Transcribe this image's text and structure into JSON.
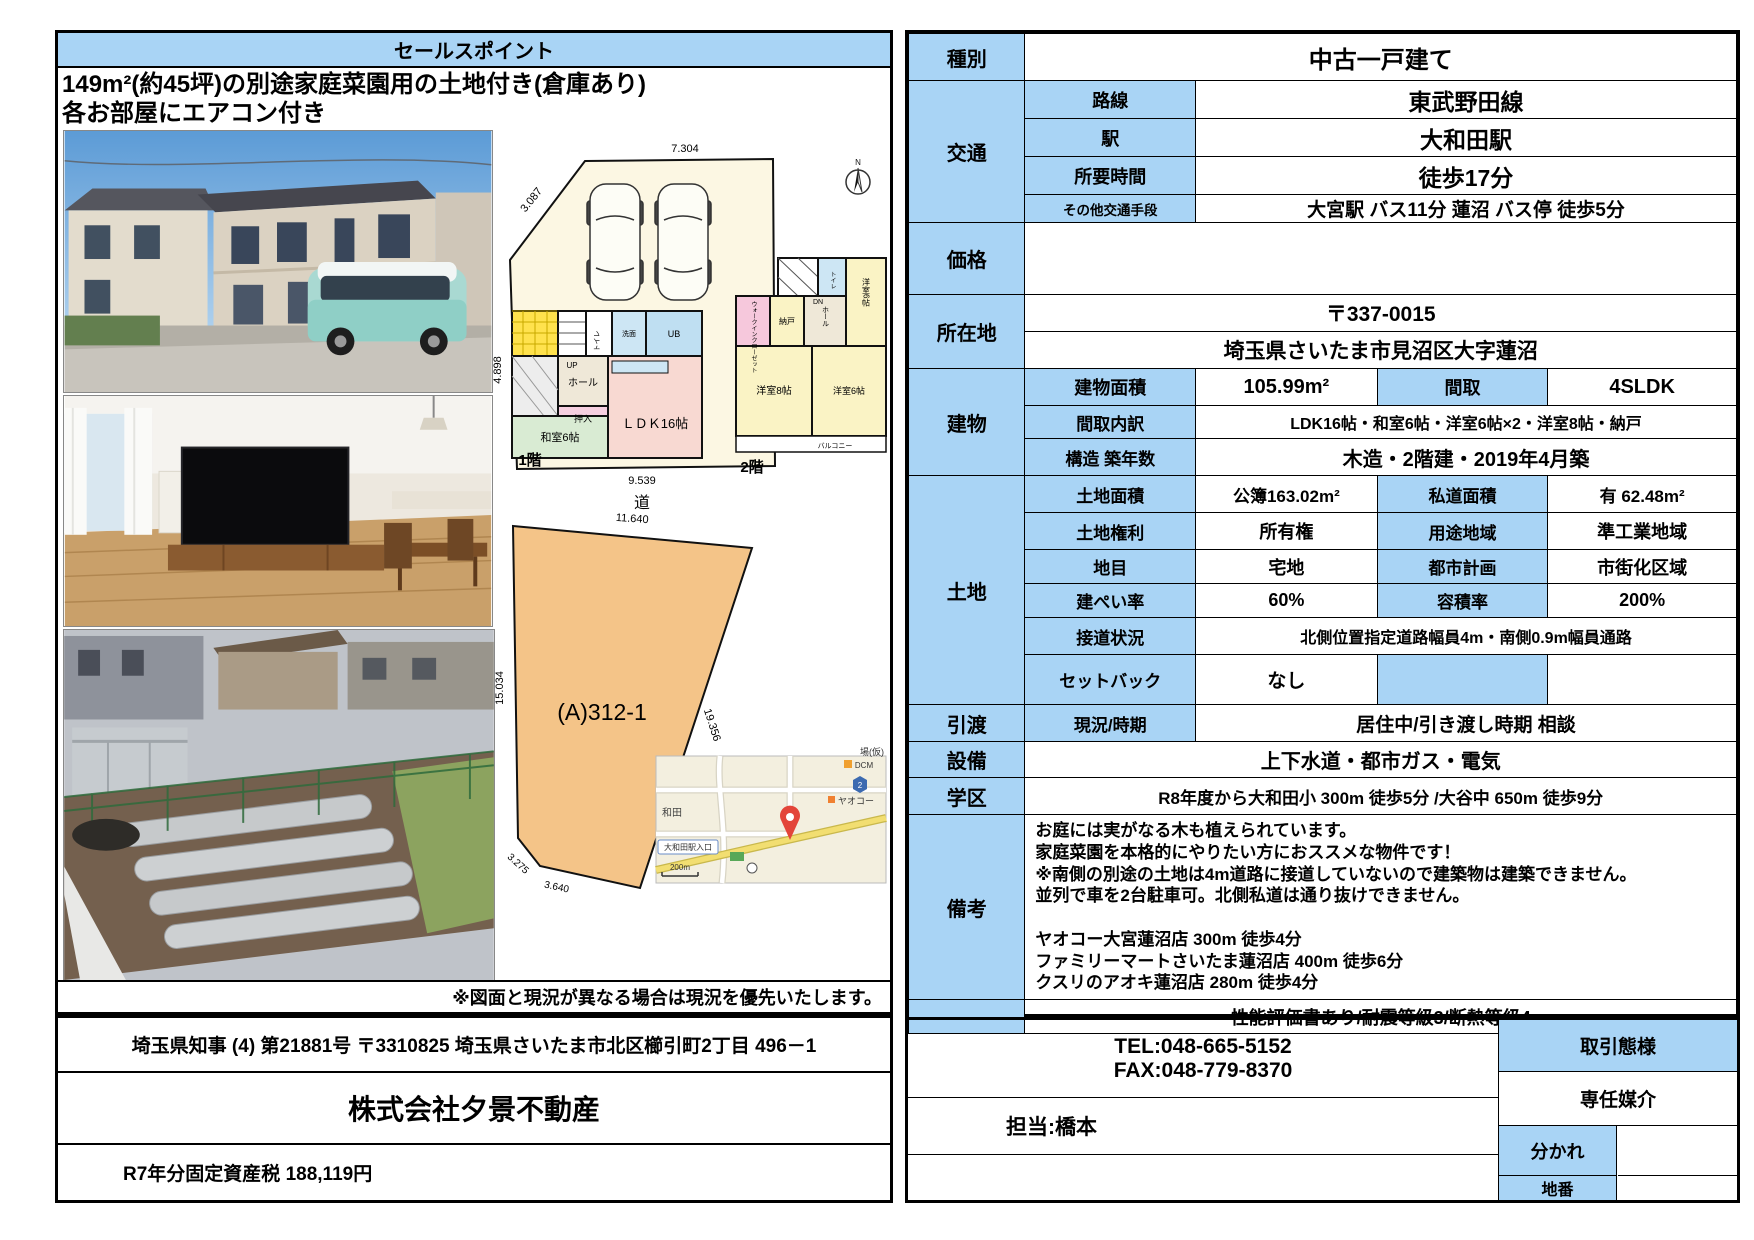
{
  "colors": {
    "cell_blue": "#A9D4F5",
    "plot_orange": "#F4C488",
    "map_bg": "#F3EFDF",
    "pin_red": "#E3453A"
  },
  "left": {
    "header": "セールスポイント",
    "sales_line1": "149m²(約45坪)の別途家庭菜園用の土地付き(倉庫あり)",
    "sales_line2": "各お部屋にエアコン付き",
    "note": "※図面と現況が異なる場合は現況を優先いたします。",
    "license": "埼玉県知事 (4) 第21881号 〒3310825 埼玉県さいたま市北区櫛引町2丁目 496－1",
    "company": "株式会社夕景不動産",
    "tax": "R7年分固定資産税 188,119円"
  },
  "plan1f": {
    "floor": "1階",
    "road": "道",
    "dim_top": "7.304",
    "dim_diag": "3.087",
    "dim_left": "4.898",
    "dim_right": "17.706",
    "dim_bottom": "9.539",
    "up": "UP",
    "toilet": "トイレ",
    "wash": "洗面",
    "ub": "UB",
    "hall": "ホール",
    "oshiire": "押入",
    "washitsu": "和室6帖",
    "ldk": "ＬＤＫ16帖"
  },
  "plan2f": {
    "floor": "2階",
    "dn": "DN",
    "toilet": "トイレ",
    "wic": "ウォークインクローゼット",
    "nando": "納戸",
    "hall": "ホール",
    "y6a": "洋室6帖",
    "y8": "洋室8帖",
    "y6b": "洋室6帖",
    "balcony": "バルコニー"
  },
  "plot": {
    "name": "(A)312-1",
    "d_top": "11.640",
    "d_left": "15.034",
    "d_right": "19.356",
    "d_b1": "3.275",
    "d_b2": "3.640"
  },
  "map": {
    "yaoko": "ヤオコー",
    "dcm": "DCM",
    "wada": "和田",
    "station": "大和田駅入口",
    "ba": "場(仮)",
    "scale": "200m",
    "badge": "2"
  },
  "compass": {
    "n": "N"
  },
  "spec": {
    "type_k": "種別",
    "type_v": "中古一戸建て",
    "access_k": "交通",
    "access": [
      {
        "k": "路線",
        "v": "東武野田線"
      },
      {
        "k": "駅",
        "v": "大和田駅"
      },
      {
        "k": "所要時間",
        "v": "徒歩17分"
      },
      {
        "k": "その他交通手段",
        "v": "大宮駅 バス11分 蓮沼 バス停 徒歩5分"
      }
    ],
    "price_k": "価格",
    "price_v": "",
    "loc_k": "所在地",
    "loc_zip": "〒337-0015",
    "loc_addr": "埼玉県さいたま市見沼区大字蓮沼",
    "bld_k": "建物",
    "bld_area_k": "建物面積",
    "bld_area_v": "105.99m²",
    "bld_madori_k": "間取",
    "bld_madori_v": "4SLDK",
    "bld_uchi_k": "間取内訳",
    "bld_uchi_v": "LDK16帖・和室6帖・洋室6帖×2・洋室8帖・納戸",
    "bld_kozo_k": "構造 築年数",
    "bld_kozo_v": "木造・2階建・2019年4月築",
    "land_k": "土地",
    "land_rows": [
      {
        "k1": "土地面積",
        "v1": "公簿163.02m²",
        "k2": "私道面積",
        "v2": "有 62.48m²"
      },
      {
        "k1": "土地権利",
        "v1": "所有権",
        "k2": "用途地域",
        "v2": "準工業地域"
      },
      {
        "k1": "地目",
        "v1": "宅地",
        "k2": "都市計画",
        "v2": "市街化区域"
      },
      {
        "k1": "建ぺい率",
        "v1": "60%",
        "k2": "容積率",
        "v2": "200%"
      }
    ],
    "land_setsudo_k": "接道状況",
    "land_setsudo_v": "北側位置指定道路幅員4m・南側0.9m幅員通路",
    "land_setback_k": "セットバック",
    "land_setback_v": "なし",
    "hikiwatashi_k": "引渡",
    "hikiwatashi_sub": "現況/時期",
    "hikiwatashi_v": "居住中/引き渡し時期 相談",
    "setsubi_k": "設備",
    "setsubi_v": "上下水道・都市ガス・電気",
    "gakku_k": "学区",
    "gakku_v": "R8年度から大和田小 300m 徒歩5分 /大谷中 650m 徒歩9分",
    "biko_k": "備考",
    "biko_lines": [
      "お庭には実がなる木も植えられています。",
      "家庭菜園を本格的にやりたい方におススメな物件です！",
      "※南側の別途の土地は4m道路に接道していないので建築物は建築できません。",
      "並列で車を2台駐車可。北側私道は通り抜けできません。",
      "",
      "ヤオコー大宮蓮沼店 300m 徒歩4分",
      "ファミリーマートさいたま蓮沼店 400m 徒歩6分",
      "クスリのアオキ蓮沼店 280m 徒歩4分"
    ],
    "performance": "性能評価書あり/耐震等級3/断熱等級4"
  },
  "contact": {
    "tel": "TEL:048-665-5152",
    "fax": "FAX:048-779-8370",
    "tanto": "担当:橋本",
    "torihiki_k": "取引態様",
    "torihiki_v": "専任媒介",
    "wakare_k": "分かれ",
    "chiban_k": "地番"
  }
}
